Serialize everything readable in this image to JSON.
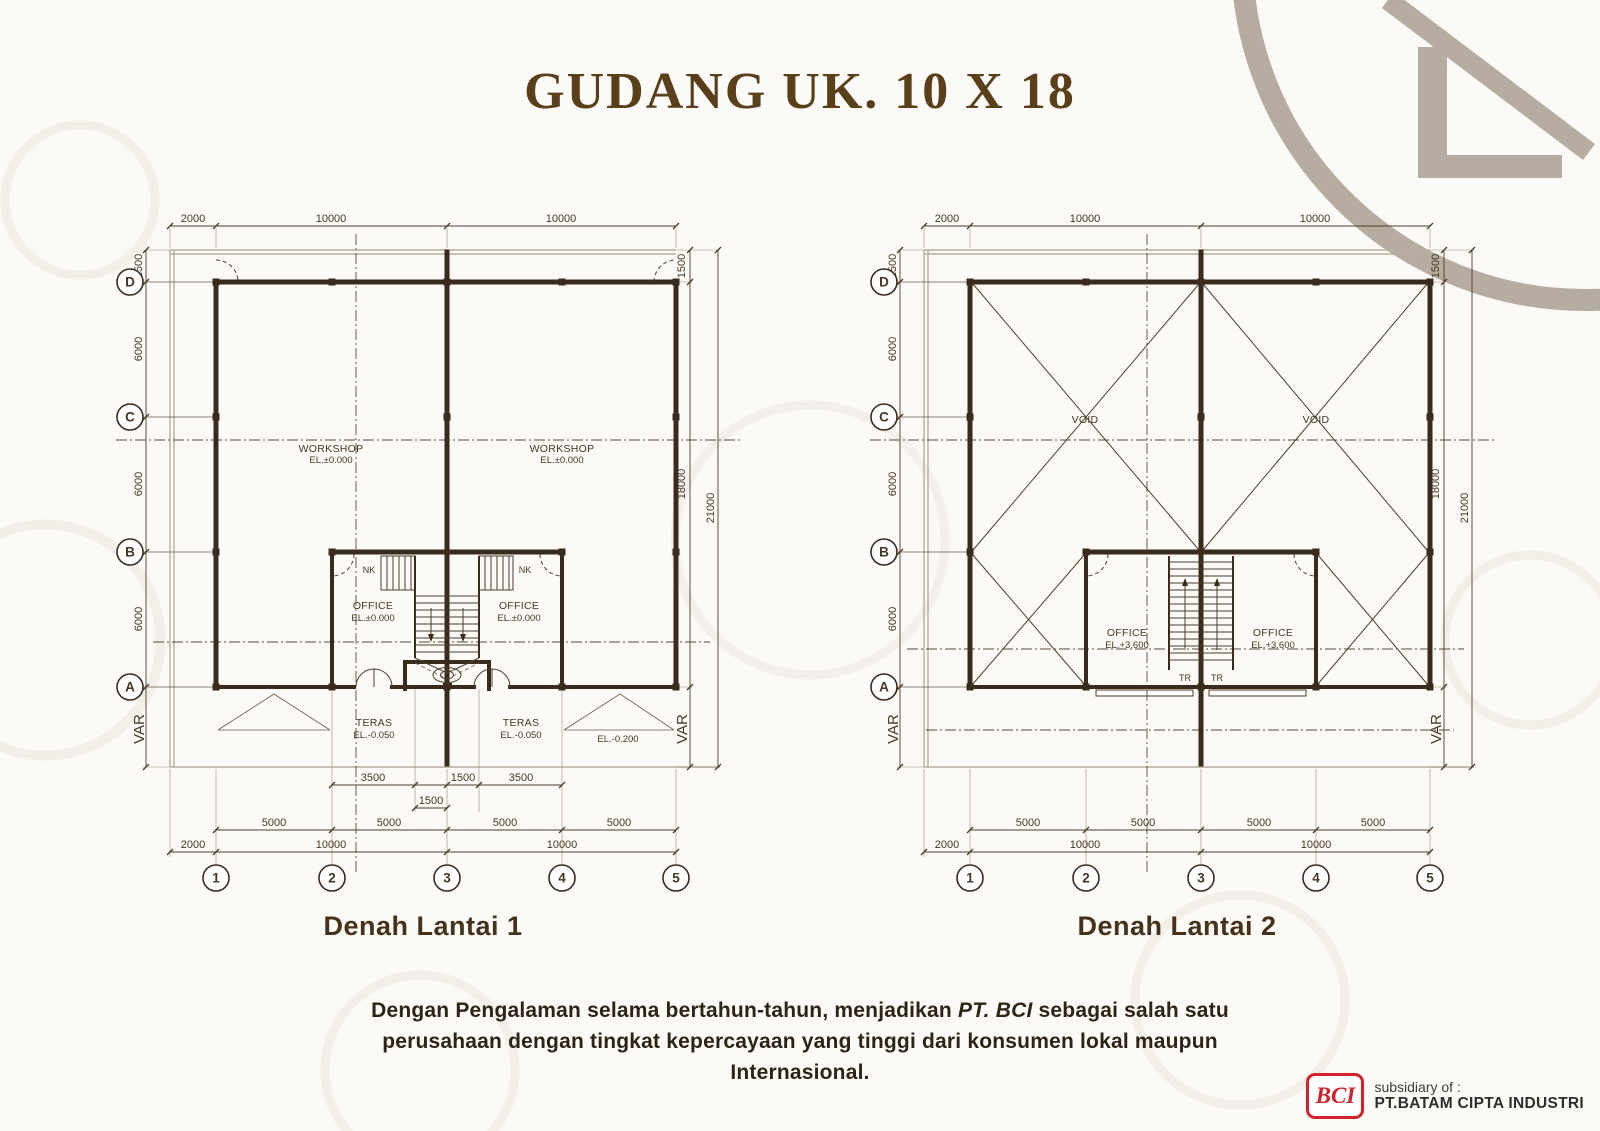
{
  "title": "GUDANG UK. 10 X 18",
  "colors": {
    "title_brown": "#5a3f1b",
    "drawing_brown": "#3a2b1c",
    "brand_red": "#d2232a",
    "watermark_taupe": "#b7aca0"
  },
  "plan1": {
    "caption": "Denah Lantai 1",
    "grid": {
      "rows": [
        "D",
        "C",
        "B",
        "A"
      ],
      "cols": [
        "1",
        "2",
        "3",
        "4",
        "5"
      ]
    },
    "dims": {
      "top": [
        "2000",
        "10000",
        "10000"
      ],
      "left": [
        "1500",
        "6000",
        "6000",
        "6000"
      ],
      "left_var": "VAR",
      "right": [
        "1500",
        "18000",
        "21000",
        "VAR"
      ],
      "bottom1": [
        "3500",
        "1500",
        "3500"
      ],
      "bottom2": "1500",
      "bottom3": [
        "5000",
        "5000",
        "5000",
        "5000"
      ],
      "bottom4": [
        "2000",
        "10000",
        "10000"
      ]
    },
    "labels": {
      "workshop": [
        "WORKSHOP",
        "EL.±0.000"
      ],
      "office": [
        "OFFICE",
        "EL.±0.000"
      ],
      "teras": [
        "TERAS",
        "EL.-0.050"
      ],
      "ramp_el": "EL.-0.200",
      "nk": "NK"
    }
  },
  "plan2": {
    "caption": "Denah Lantai 2",
    "grid": {
      "rows": [
        "D",
        "C",
        "B",
        "A"
      ],
      "cols": [
        "1",
        "2",
        "3",
        "4",
        "5"
      ]
    },
    "dims": {
      "top": [
        "2000",
        "10000",
        "10000"
      ],
      "left": [
        "1500",
        "6000",
        "6000",
        "6000"
      ],
      "left_var": "VAR",
      "right": [
        "1500",
        "18000",
        "21000",
        "VAR"
      ],
      "bottom3": [
        "5000",
        "5000",
        "5000",
        "5000"
      ],
      "bottom4": [
        "2000",
        "10000",
        "10000"
      ]
    },
    "labels": {
      "void": "VOID",
      "office": [
        "OFFICE",
        "EL.+3.600"
      ],
      "tr": "TR"
    }
  },
  "footer": {
    "segments": [
      "Dengan Pengalaman selama bertahun-tahun, menjadikan ",
      "PT. BCI",
      " sebagai salah satu perusahaan dengan tingkat  kepercayaan yang tinggi dari konsumen lokal maupun Internasional."
    ]
  },
  "brand": {
    "abbr": "BCI",
    "subsidiary": "subsidiary of :",
    "company": "PT.BATAM CIPTA INDUSTRI"
  }
}
